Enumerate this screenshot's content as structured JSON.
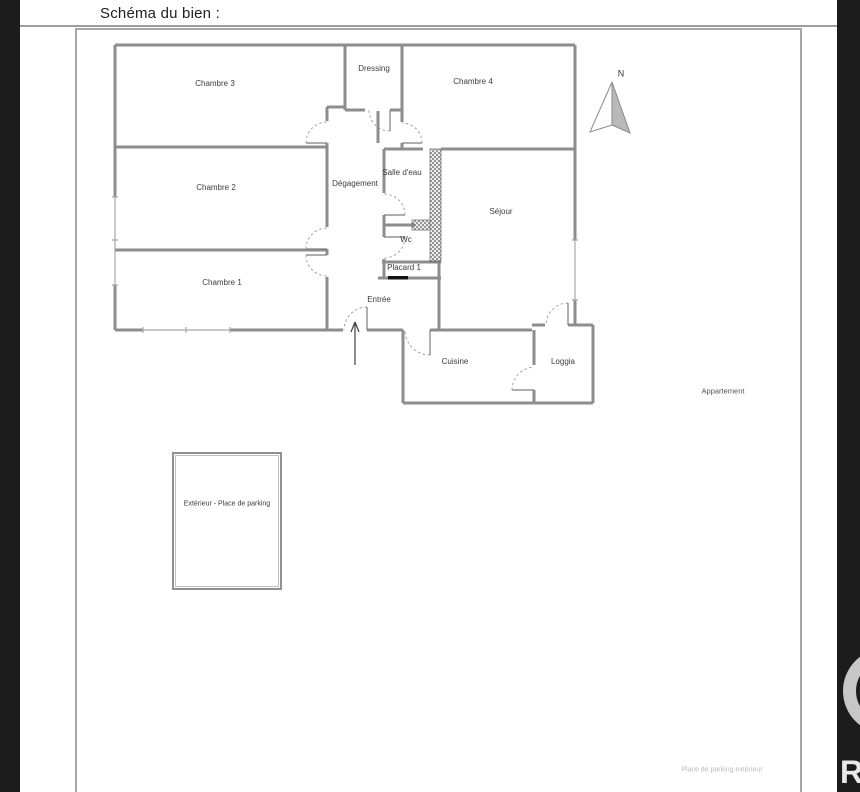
{
  "header": {
    "title": "Schéma du bien :"
  },
  "floor_plan": {
    "rooms": [
      {
        "id": "chambre-3",
        "label": "Chambre 3"
      },
      {
        "id": "dressing",
        "label": "Dressing"
      },
      {
        "id": "chambre-4",
        "label": "Chambre 4"
      },
      {
        "id": "chambre-2",
        "label": "Chambre 2"
      },
      {
        "id": "degagement",
        "label": "Dégagement"
      },
      {
        "id": "salle-deau",
        "label": "Salle d'eau"
      },
      {
        "id": "sejour",
        "label": "Séjour"
      },
      {
        "id": "wc",
        "label": "Wc"
      },
      {
        "id": "placard-1",
        "label": "Placard 1"
      },
      {
        "id": "chambre-1",
        "label": "Chambre 1"
      },
      {
        "id": "entree",
        "label": "Entrée"
      },
      {
        "id": "cuisine",
        "label": "Cuisine"
      },
      {
        "id": "loggia",
        "label": "Loggia"
      }
    ],
    "compass_label": "N",
    "area_label": "Appartement"
  },
  "exterior": {
    "parking_box_label": "Extérieur - Place de parking",
    "caption": "Place de parking extérieur"
  },
  "watermark": {
    "letter": "R"
  },
  "colors": {
    "wall": "#8d8d8d",
    "door_arc": "#9a9a9a",
    "hatch": "#6f6f6f",
    "label_text": "#3c3c3c",
    "frame_border": "#a6a6a6",
    "photo_bar": "#1c1c1c",
    "faint_caption": "#b9b9b9"
  }
}
